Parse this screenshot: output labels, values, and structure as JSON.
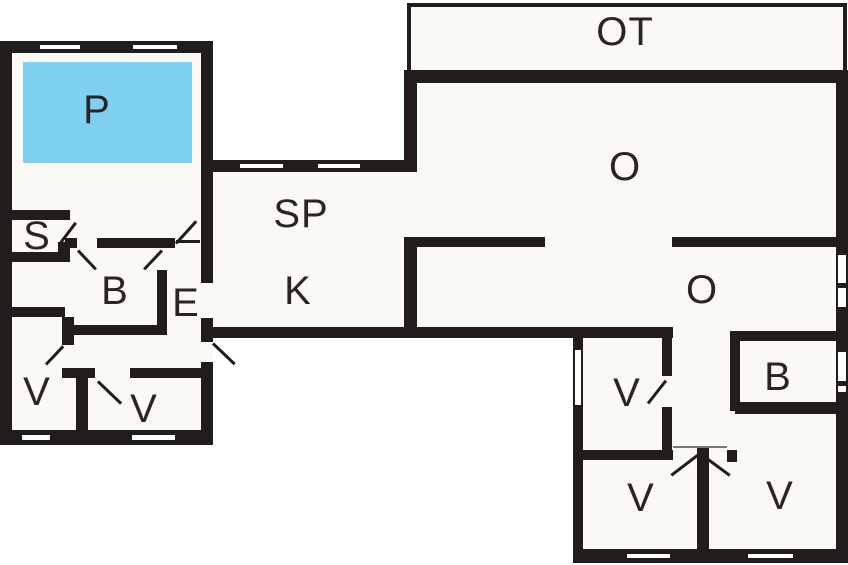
{
  "title": "Floor plan",
  "colors": {
    "wall": "#211d1c",
    "floor": "#faf9f4",
    "pool": "#7ed1f0",
    "label": "#2a2523"
  },
  "rooms": [
    {
      "id": "pool",
      "label": "P"
    },
    {
      "id": "storage",
      "label": "S"
    },
    {
      "id": "bath-left",
      "label": "B"
    },
    {
      "id": "entry",
      "label": "E"
    },
    {
      "id": "room-left-1",
      "label": "V"
    },
    {
      "id": "room-left-2",
      "label": "V"
    },
    {
      "id": "dining",
      "label": "SP"
    },
    {
      "id": "kitchen",
      "label": "K"
    },
    {
      "id": "terrace",
      "label": "OT"
    },
    {
      "id": "living-large",
      "label": "O"
    },
    {
      "id": "living-small",
      "label": "O"
    },
    {
      "id": "room-right-1",
      "label": "V"
    },
    {
      "id": "bath-right",
      "label": "B"
    },
    {
      "id": "room-right-2",
      "label": "V"
    },
    {
      "id": "room-right-3",
      "label": "V"
    }
  ]
}
